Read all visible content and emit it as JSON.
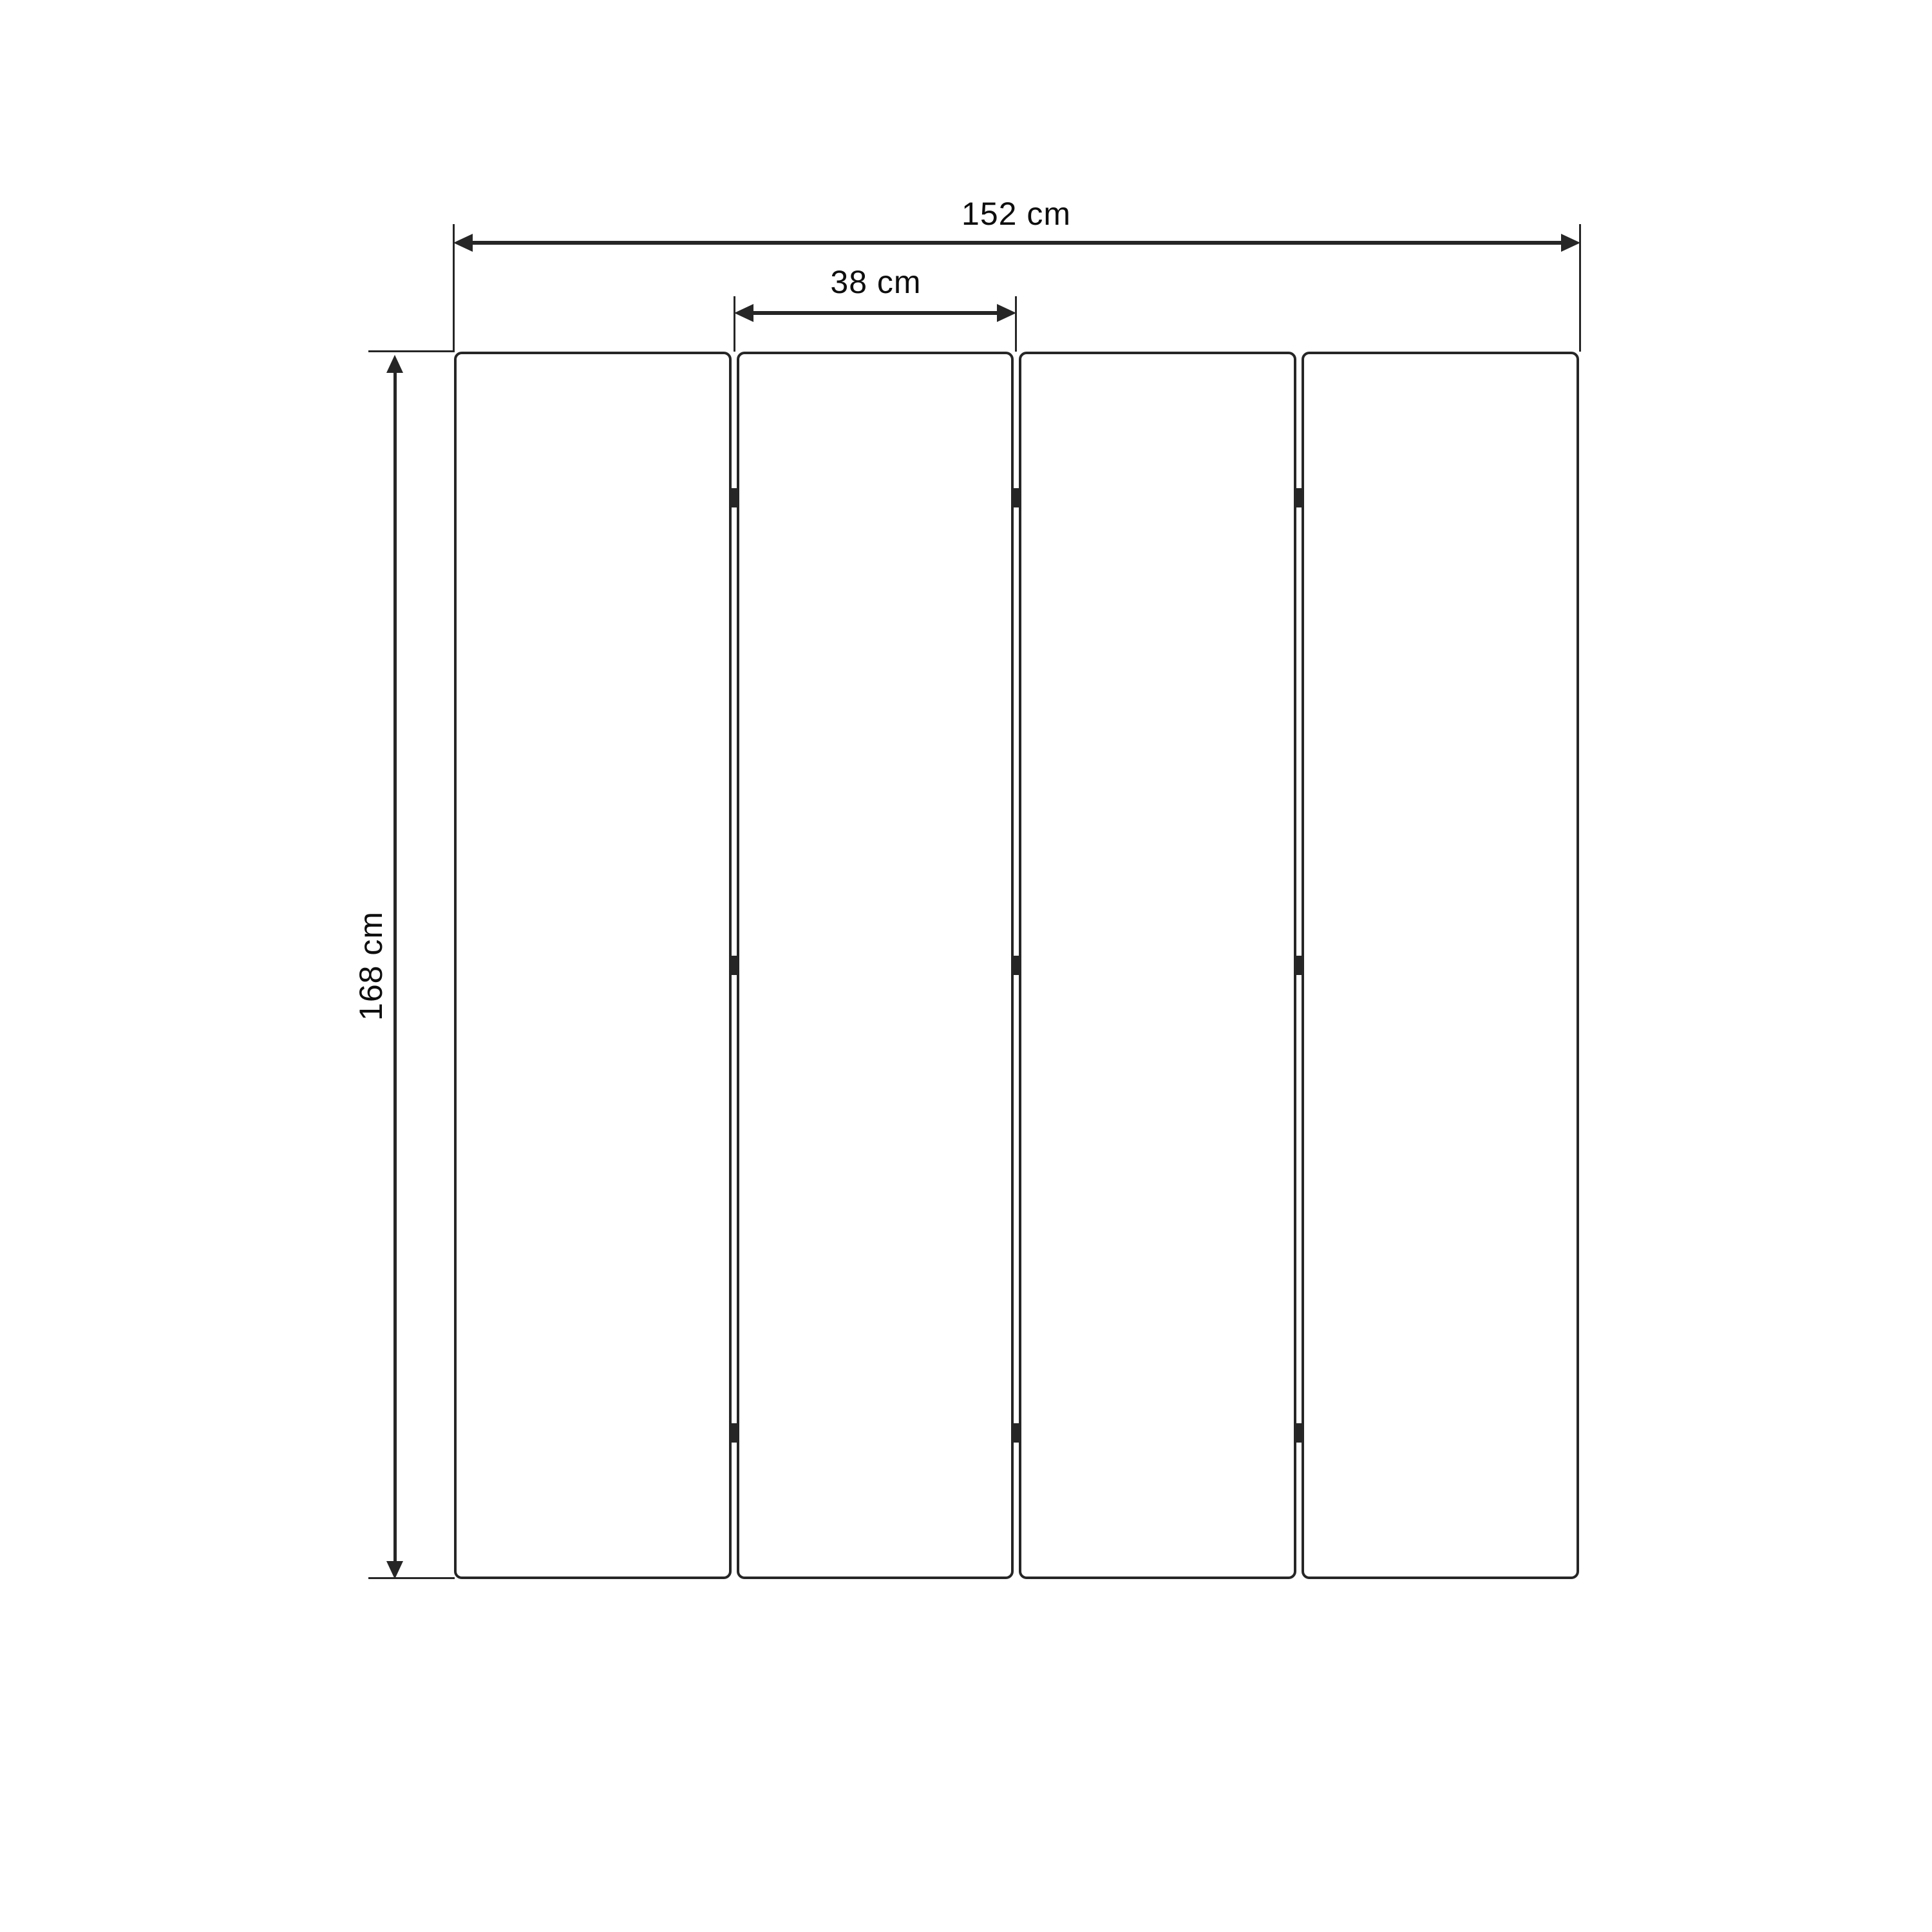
{
  "diagram": {
    "kind": "folding-screen-dimension-drawing",
    "dimensions": {
      "total_width": {
        "label": "152 cm"
      },
      "panel_width": {
        "label": "38 cm"
      },
      "height": {
        "label": "168 cm"
      }
    },
    "panels": {
      "count": 4
    },
    "hinges": {
      "per_gap": 3,
      "total": 9
    },
    "colors": {
      "line": "#262626",
      "text": "#0e0e0e",
      "background": "#ffffff"
    }
  }
}
